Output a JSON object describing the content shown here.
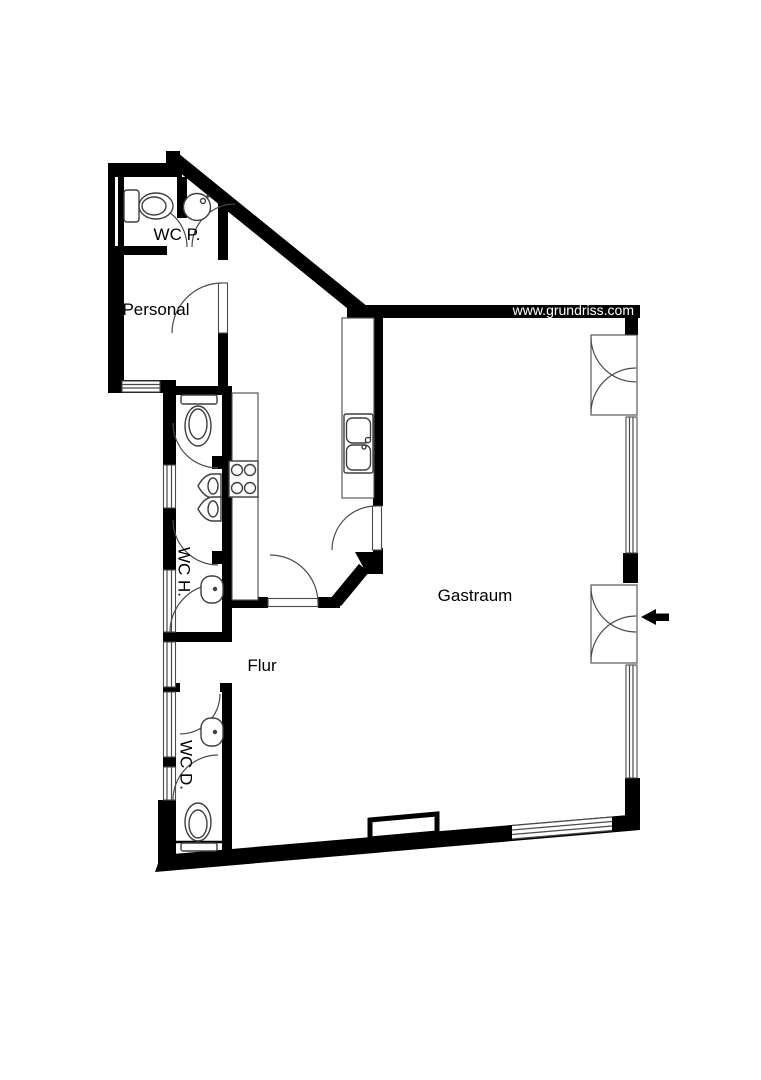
{
  "plan": {
    "watermark": "www.grundriss.com",
    "colors": {
      "wall": "#000000",
      "fixture_line": "#3f3f3f",
      "background": "#ffffff",
      "watermark_text": "#ffffff"
    },
    "rooms": {
      "wc_p": {
        "label": "WC P."
      },
      "personal": {
        "label": "Personal"
      },
      "wc_h": {
        "label": "WC H."
      },
      "flur": {
        "label": "Flur"
      },
      "wc_d": {
        "label": "WC D."
      },
      "gastraum": {
        "label": "Gastraum"
      }
    },
    "symbols": {
      "entrance_arrow_direction": "left"
    }
  }
}
